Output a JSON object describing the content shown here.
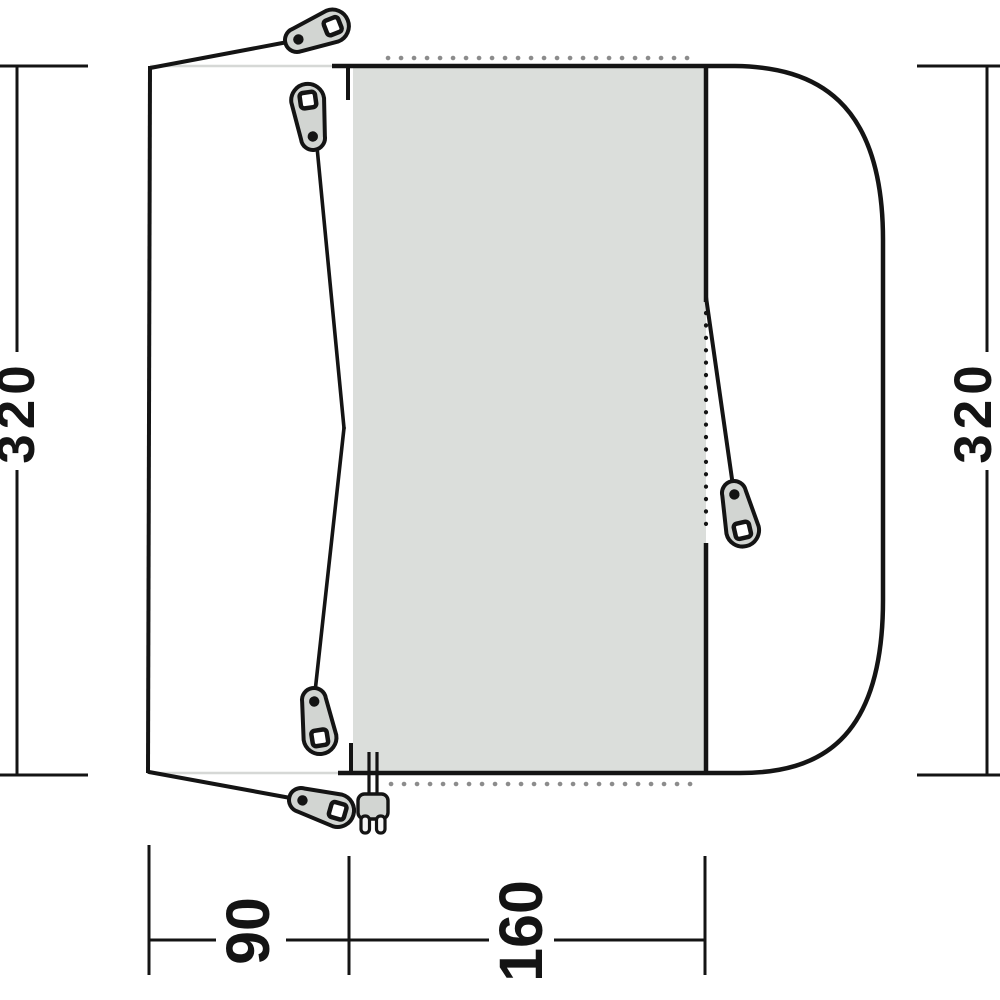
{
  "diagram": {
    "name": "tent-awning-floorplan",
    "labels": {
      "height_left": "320",
      "height_right": "320",
      "width_porch": "90",
      "width_inner": "160"
    },
    "icons": {
      "tensioner": "guyline-tensioner",
      "plug": "power-plug",
      "dots_top": "toggle-points-top",
      "dots_bottom": "toggle-points-bottom",
      "dots_door": "zipper-door-line"
    },
    "colors": {
      "outline": "#141414",
      "inner_fill": "#dbdedb",
      "hardware_fill": "#d2d5d2",
      "dots": "#8c8c8c",
      "canopy_edge": "#d6d8d6",
      "hole_fill": "#ffffff"
    }
  }
}
